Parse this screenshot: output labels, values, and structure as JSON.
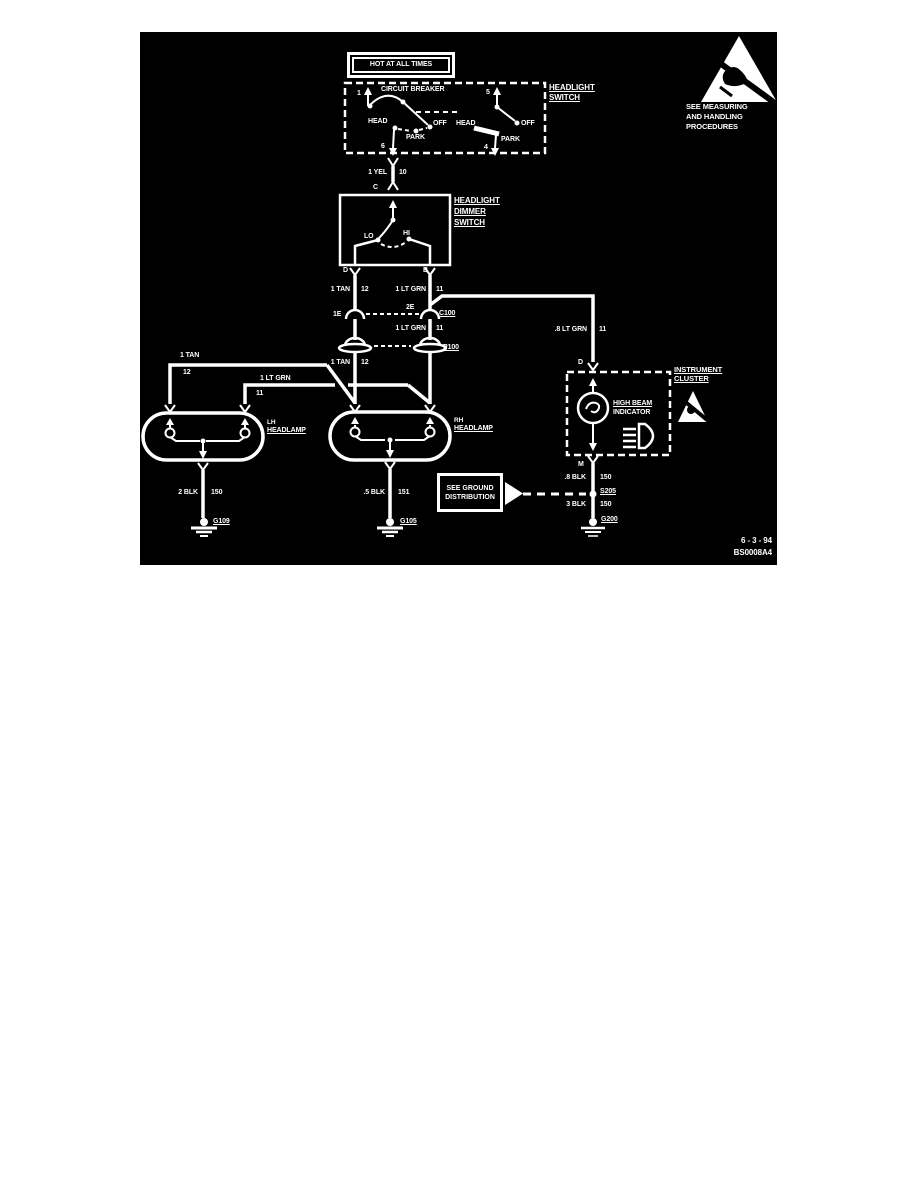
{
  "colors": {
    "page_bg": "#ffffff",
    "panel_bg": "#000000",
    "ink": "#ffffff"
  },
  "power": {
    "hot": "HOT AT ALL TIMES"
  },
  "headlight_switch": {
    "title1": "HEADLIGHT",
    "title2": "SWITCH",
    "breaker": "CIRCUIT BREAKER",
    "left": {
      "t_top": "1",
      "head": "HEAD",
      "off": "OFF",
      "park": "PARK",
      "t_bot": "6"
    },
    "right": {
      "t_top": "5",
      "head": "HEAD",
      "off": "OFF",
      "park": "PARK",
      "t_bot": "4"
    }
  },
  "dimmer_switch": {
    "title1": "HEADLIGHT",
    "title2": "DIMMER",
    "title3": "SWITCH",
    "term_c": "C",
    "lo": "LO",
    "hi": "HI",
    "term_d": "D",
    "term_b": "B"
  },
  "wires": {
    "yel": {
      "name": "1 YEL",
      "ckt": "10"
    },
    "tan_upper": {
      "name": "1 TAN",
      "ckt": "12"
    },
    "grn_upper": {
      "name": "1 LT GRN",
      "ckt": "11"
    },
    "grn_mid": {
      "name": "1 LT GRN",
      "ckt": "11"
    },
    "tan_mid": {
      "name": "1 TAN",
      "ckt": "12"
    },
    "grn_cluster": {
      "name": ".8 LT GRN",
      "ckt": "11"
    },
    "tan_lh": {
      "name": "1 TAN",
      "ckt": "12"
    },
    "grn_lh": {
      "name": "1 LT GRN",
      "ckt": "11"
    },
    "blk_lh": {
      "name": "2 BLK",
      "ckt": "150"
    },
    "blk_rh": {
      "name": ".5 BLK",
      "ckt": "151"
    },
    "blk_cluster_upper": {
      "name": ".8 BLK",
      "ckt": "150"
    },
    "blk_cluster_lower": {
      "name": "3 BLK",
      "ckt": "150"
    }
  },
  "connectors": {
    "pin_1e": "1E",
    "pin_2e": "2E",
    "c100": "C100",
    "p100": "P100"
  },
  "lamps": {
    "lh1": "LH",
    "lh2": "HEADLAMP",
    "rh1": "RH",
    "rh2": "HEADLAMP"
  },
  "grounds": {
    "g109": "G109",
    "g105": "G105",
    "g200": "G200",
    "s205": "S205"
  },
  "cluster": {
    "title1": "INSTRUMENT",
    "title2": "CLUSTER",
    "term_d": "D",
    "term_m": "M",
    "ind1": "HIGH BEAM",
    "ind2": "INDICATOR"
  },
  "notes": {
    "gnd1": "SEE GROUND",
    "gnd2": "DISTRIBUTION",
    "esd1": "SEE MEASURING",
    "esd2": "AND HANDLING",
    "esd3": "PROCEDURES"
  },
  "footer": {
    "date": "6 - 3 - 94",
    "ref": "BS0008A4"
  }
}
